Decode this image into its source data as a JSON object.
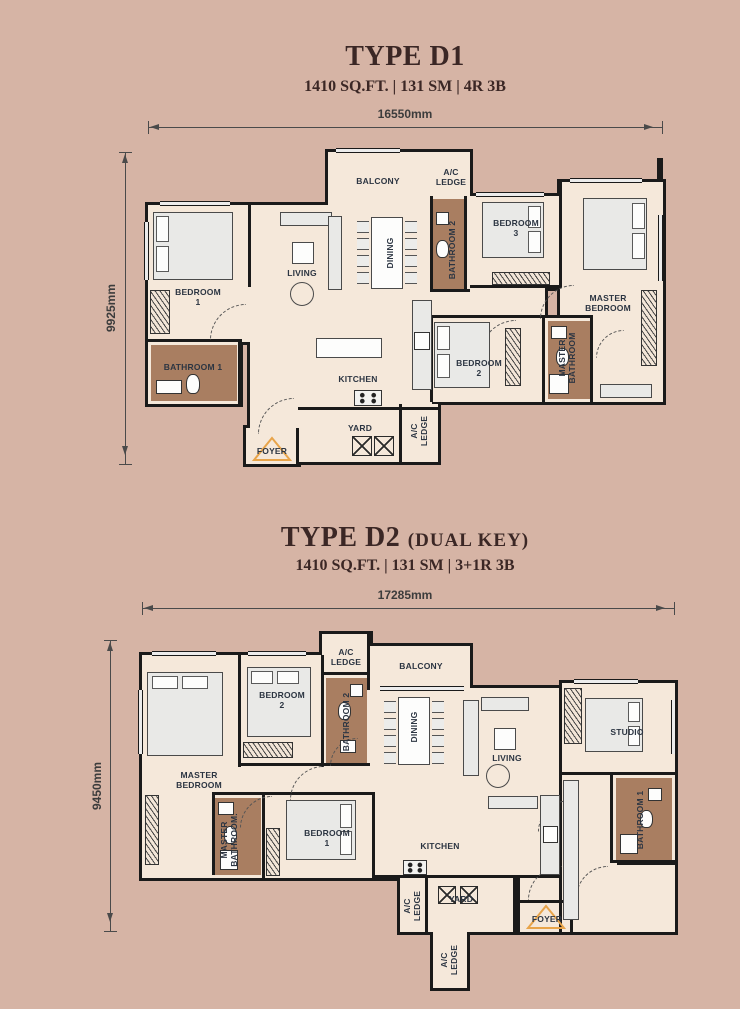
{
  "colors": {
    "background": "#d6b4a5",
    "floor": "#f5e8da",
    "bathroom_floor": "#a97e61",
    "wall": "#1a1a1a",
    "room_label": "#2c3542",
    "title_text": "#3b2725",
    "dimension_text": "#3c3c3c",
    "accent_orange": "#e8a44a",
    "furniture_fill": "#e9e9e7"
  },
  "d1": {
    "title": "TYPE D1",
    "title_suffix": "",
    "spec": "1410 SQ.FT. | 131 SM | 4R 3B",
    "dim_width": "16550mm",
    "dim_height": "9925mm",
    "rooms": {
      "balcony": "BALCONY",
      "ac_ledge_top": "A/C\nLEDGE",
      "bedroom3": "BEDROOM\n3",
      "living": "LIVING",
      "dining": "DINING",
      "bathroom2": "BATHROOM 2",
      "master_bedroom": "MASTER\nBEDROOM",
      "bedroom1": "BEDROOM\n1",
      "bathroom1": "BATHROOM 1",
      "kitchen": "KITCHEN",
      "bedroom2": "BEDROOM\n2",
      "master_bathroom": "MASTER\nBATHROOM",
      "yard": "YARD",
      "ac_ledge_bottom": "A/C\nLEDGE",
      "foyer": "FOYER"
    }
  },
  "d2": {
    "title": "TYPE D2",
    "title_suffix": "(DUAL KEY)",
    "spec": "1410 SQ.FT. | 131 SM | 3+1R 3B",
    "dim_width": "17285mm",
    "dim_height": "9450mm",
    "rooms": {
      "ac_ledge_top": "A/C\nLEDGE",
      "balcony": "BALCONY",
      "bedroom2": "BEDROOM\n2",
      "bathroom2": "BATHROOM 2",
      "master_bedroom": "MASTER\nBEDROOM",
      "dining": "DINING",
      "living": "LIVING",
      "studio": "STUDIO",
      "master_bathroom": "MASTER\nBATHROOM.",
      "bedroom1": "BEDROOM\n1",
      "kitchen": "KITCHEN",
      "bathroom1": "BATHROOM 1",
      "ac_ledge_mid": "A/C\nLEDGE",
      "yard": "YARD",
      "foyer": "FOYER",
      "ac_ledge_bottom": "A/C\nLEDGE"
    }
  }
}
